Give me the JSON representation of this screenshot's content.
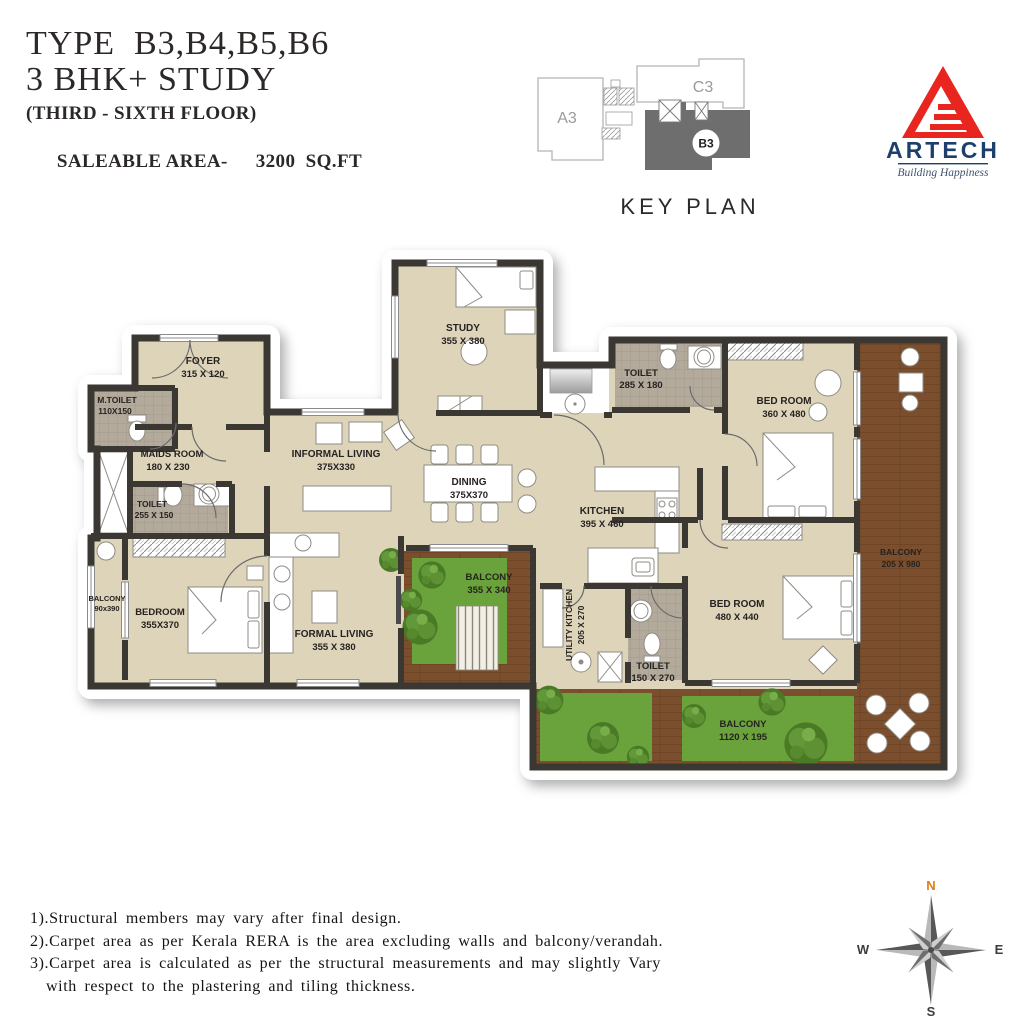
{
  "header": {
    "title_line1": "TYPE  B3,B4,B5,B6",
    "title_line2": "3 BHK+ STUDY",
    "floor_line": "(THIRD - SIXTH FLOOR)",
    "saleable_label": "SALEABLE AREA-",
    "saleable_value": "3200  SQ.FT"
  },
  "key_plan": {
    "caption": "KEY PLAN",
    "unit_a": "A3",
    "unit_c": "C3",
    "unit_b": "B3",
    "highlighted_unit": "B3"
  },
  "logo": {
    "brand": "ARTECH",
    "tagline": "Building Happiness"
  },
  "rooms": [
    {
      "name": "FOYER",
      "dims": "315 X 120"
    },
    {
      "name": "M.TOILET",
      "dims": "110X150"
    },
    {
      "name": "MAIDS ROOM",
      "dims": "180 X 230"
    },
    {
      "name": "TOILET",
      "dims": "255 X 150"
    },
    {
      "name": "INFORMAL LIVING",
      "dims": "375X330"
    },
    {
      "name": "STUDY",
      "dims": "355 X 380"
    },
    {
      "name": "DINING",
      "dims": "375X370"
    },
    {
      "name": "KITCHEN",
      "dims": "395 X 460"
    },
    {
      "name": "TOILET",
      "dims": "285 X 180"
    },
    {
      "name": "BED ROOM",
      "dims": "360 X 480"
    },
    {
      "name": "BALCONY",
      "dims": "90x390"
    },
    {
      "name": "BEDROOM",
      "dims": "355X370"
    },
    {
      "name": "FORMAL LIVING",
      "dims": "355 X 380"
    },
    {
      "name": "BALCONY",
      "dims": "355 X 340"
    },
    {
      "name": "UTILITY KITCHEN",
      "dims": "205 X 270"
    },
    {
      "name": "TOILET",
      "dims": "150 X 270"
    },
    {
      "name": "BED ROOM",
      "dims": "480 X 440"
    },
    {
      "name": "BALCONY",
      "dims": "205 X 980"
    },
    {
      "name": "BALCONY",
      "dims": "1120 X 195"
    }
  ],
  "notes": [
    "1).Structural members may vary after final design.",
    "2).Carpet area as per Kerala RERA is the area excluding walls and balcony/verandah.",
    "3).Carpet area is calculated as per the structural measurements and may slightly Vary",
    "with respect to the plastering and tiling thickness."
  ],
  "compass": {
    "n": "N",
    "e": "E",
    "s": "S",
    "w": "W"
  },
  "colors": {
    "wall": "#3b3733",
    "floor": "#ddd4ba",
    "toilet_floor": "#b3aa9b",
    "deck_wood": "#7b4f2e",
    "grass": "#6aa23c",
    "logo_red": "#e8251f",
    "logo_navy": "#1c3f6e",
    "keyplan_highlight": "#6e6e6e",
    "compass_north": "#e07e12"
  }
}
